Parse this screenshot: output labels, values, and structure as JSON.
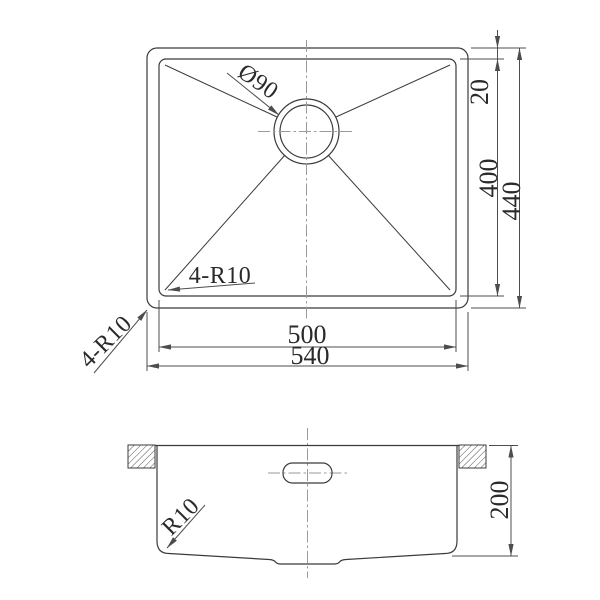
{
  "drawing": {
    "background": "#ffffff",
    "line_color": "#3b3b3b",
    "dimension_color": "#4d4d4d",
    "centerline_color": "#9a9a9a",
    "top_view": {
      "drain_diameter": "Ø90",
      "rim_offset": "20",
      "bowl_length": "500",
      "overall_length": "540",
      "bowl_width": "400",
      "overall_width": "440",
      "bowl_corner_radius": "4-R10",
      "outer_corner_radius": "4-R10"
    },
    "section_view": {
      "bowl_depth": "200",
      "bottom_corner_radius": "R10"
    }
  }
}
